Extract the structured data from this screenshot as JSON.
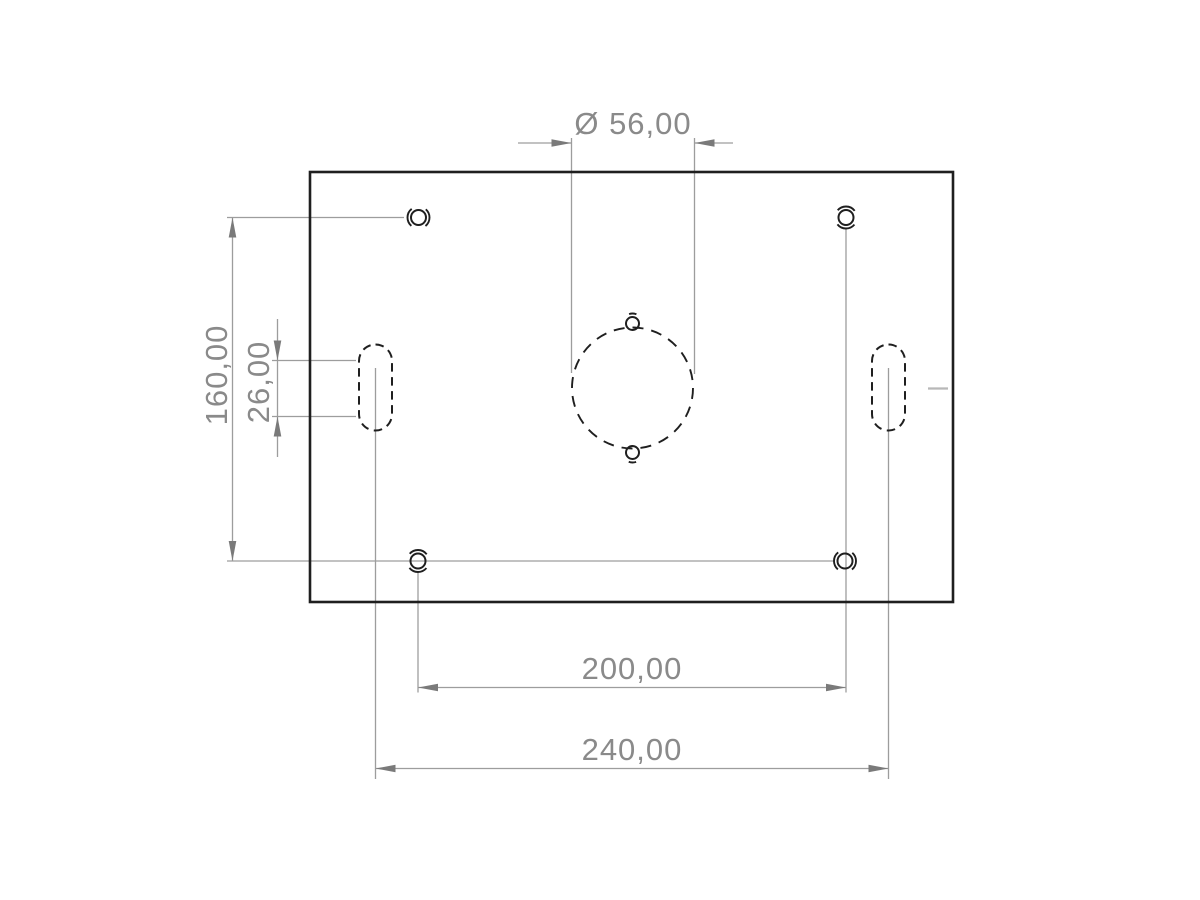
{
  "page": {
    "title": "Plate drawing — top view"
  },
  "drawing": {
    "view": "top",
    "decimal_separator": ",",
    "labels": {
      "diameter": "Ø 56,00",
      "vertical_spacing": "160,00",
      "slot_length": "26,00",
      "hole_spacing": "200,00",
      "slot_spacing": "240,00"
    },
    "values": {
      "center_circle_diameter": 56.0,
      "vertical_hole_spacing": 160.0,
      "slot_length": 26.0,
      "horizontal_hole_spacing": 200.0,
      "horizontal_slot_spacing": 240.0
    },
    "features": {
      "plate": "rectangular plate outline",
      "center_circle": "dashed circle Ø56 with small hole at top and bottom",
      "slots": [
        "left vertical slot (hidden/dashed)",
        "right vertical slot (hidden/dashed)"
      ],
      "corner_holes": [
        "top-left tapped hole",
        "top-right tapped hole",
        "bottom-left tapped hole",
        "bottom-right tapped hole"
      ]
    },
    "colors": {
      "geometry": "#1f1f1f",
      "dimension": "#9d9d9d",
      "arrow": "#7a7a7a",
      "dim_text": "#8a8a8a",
      "tick": "#b8b8b8",
      "background": "#ffffff"
    }
  }
}
